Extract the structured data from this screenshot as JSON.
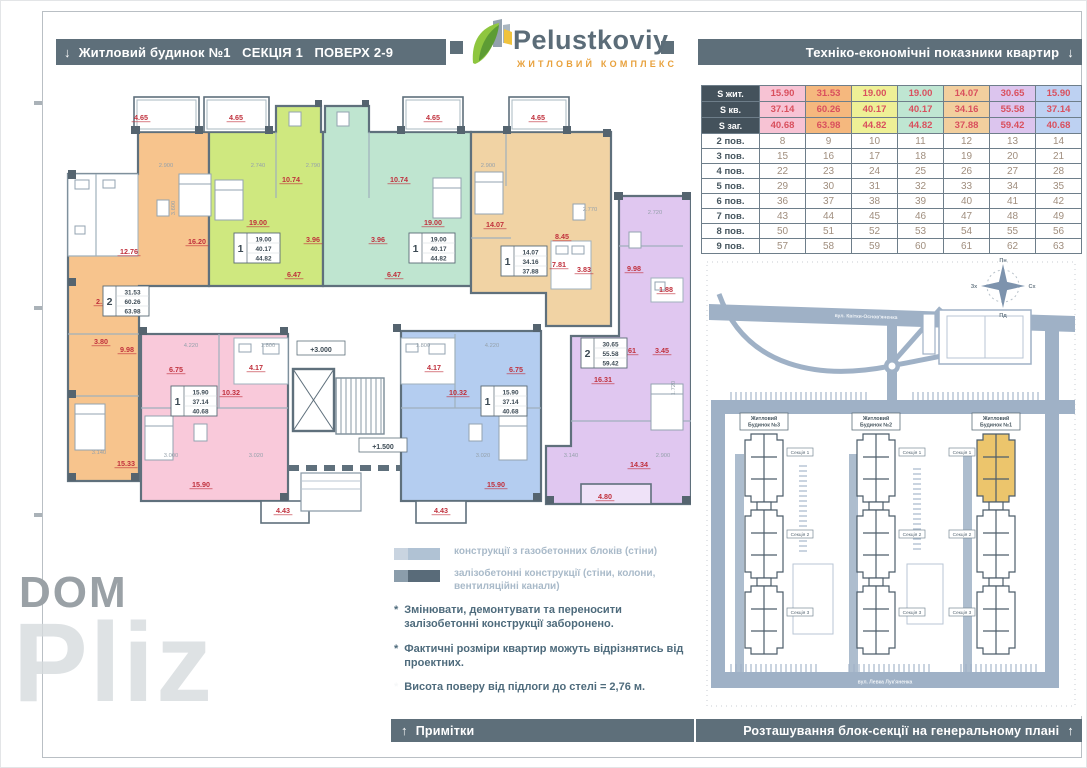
{
  "header": {
    "arrow_down": "↓",
    "left_title": "Житловий будинок №1   СЕКЦІЯ 1   ПОВЕРХ 2-9",
    "right_title": "Техніко-економічні показники квартир",
    "logo_name": "Pelustkoviy",
    "logo_subtitle": "ЖИТЛОВИЙ КОМПЛЕКС"
  },
  "table": {
    "area_rows": [
      {
        "label": "S жит.",
        "values": [
          "15.90",
          "31.53",
          "19.00",
          "19.00",
          "14.07",
          "30.65",
          "15.90"
        ]
      },
      {
        "label": "S кв.",
        "values": [
          "37.14",
          "60.26",
          "40.17",
          "40.17",
          "34.16",
          "55.58",
          "37.14"
        ]
      },
      {
        "label": "S заг.",
        "values": [
          "40.68",
          "63.98",
          "44.82",
          "44.82",
          "37.88",
          "59.42",
          "40.68"
        ]
      }
    ],
    "column_colors": [
      "#f7c3d4",
      "#f5b87e",
      "#eef096",
      "#bfe6d2",
      "#f2cf9e",
      "#dcc5ee",
      "#bdd1f2"
    ],
    "floor_rows": [
      {
        "label": "2 пов.",
        "values": [
          "8",
          "9",
          "10",
          "11",
          "12",
          "13",
          "14"
        ]
      },
      {
        "label": "3 пов.",
        "values": [
          "15",
          "16",
          "17",
          "18",
          "19",
          "20",
          "21"
        ]
      },
      {
        "label": "4 пов.",
        "values": [
          "22",
          "23",
          "24",
          "25",
          "26",
          "27",
          "28"
        ]
      },
      {
        "label": "5 пов.",
        "values": [
          "29",
          "30",
          "31",
          "32",
          "33",
          "34",
          "35"
        ]
      },
      {
        "label": "6 пов.",
        "values": [
          "36",
          "37",
          "38",
          "39",
          "40",
          "41",
          "42"
        ]
      },
      {
        "label": "7 пов.",
        "values": [
          "43",
          "44",
          "45",
          "46",
          "47",
          "48",
          "49"
        ]
      },
      {
        "label": "8 пов.",
        "values": [
          "50",
          "51",
          "52",
          "53",
          "54",
          "55",
          "56"
        ]
      },
      {
        "label": "9 пов.",
        "values": [
          "57",
          "58",
          "59",
          "60",
          "61",
          "62",
          "63"
        ]
      }
    ]
  },
  "floorplan": {
    "apartment_colors": {
      "orange": "#f7c48d",
      "lime": "#cfe87f",
      "teal": "#bfe5d0",
      "tan": "#f1d3a4",
      "purple": "#e0c7f0",
      "pink": "#f9c9da",
      "blue": "#b4cdf0"
    },
    "rooms": [
      {
        "t": "4.65",
        "x": 90,
        "y": 34
      },
      {
        "t": "4.65",
        "x": 185,
        "y": 34
      },
      {
        "t": "4.65",
        "x": 382,
        "y": 34
      },
      {
        "t": "4.65",
        "x": 487,
        "y": 34
      },
      {
        "t": "12.76",
        "x": 78,
        "y": 168
      },
      {
        "t": "16.20",
        "x": 146,
        "y": 158
      },
      {
        "t": "2.19",
        "x": 52,
        "y": 218
      },
      {
        "t": "3.80",
        "x": 50,
        "y": 258
      },
      {
        "t": "9.98",
        "x": 76,
        "y": 266
      },
      {
        "t": "15.33",
        "x": 75,
        "y": 380
      },
      {
        "t": "10.74",
        "x": 240,
        "y": 96
      },
      {
        "t": "19.00",
        "x": 207,
        "y": 139
      },
      {
        "t": "3.96",
        "x": 262,
        "y": 156
      },
      {
        "t": "6.47",
        "x": 243,
        "y": 191
      },
      {
        "t": "10.74",
        "x": 348,
        "y": 96
      },
      {
        "t": "19.00",
        "x": 382,
        "y": 139
      },
      {
        "t": "3.96",
        "x": 327,
        "y": 156
      },
      {
        "t": "6.47",
        "x": 343,
        "y": 191
      },
      {
        "t": "14.07",
        "x": 444,
        "y": 141
      },
      {
        "t": "8.45",
        "x": 511,
        "y": 153
      },
      {
        "t": "7.81",
        "x": 508,
        "y": 181
      },
      {
        "t": "3.83",
        "x": 533,
        "y": 186
      },
      {
        "t": "9.98",
        "x": 583,
        "y": 185
      },
      {
        "t": "1.88",
        "x": 615,
        "y": 206
      },
      {
        "t": "9.61",
        "x": 578,
        "y": 267
      },
      {
        "t": "3.45",
        "x": 611,
        "y": 267
      },
      {
        "t": "16.31",
        "x": 552,
        "y": 296
      },
      {
        "t": "14.34",
        "x": 588,
        "y": 381
      },
      {
        "t": "4.80",
        "x": 554,
        "y": 413
      },
      {
        "t": "6.75",
        "x": 125,
        "y": 286
      },
      {
        "t": "4.17",
        "x": 205,
        "y": 284
      },
      {
        "t": "10.32",
        "x": 180,
        "y": 309
      },
      {
        "t": "15.90",
        "x": 150,
        "y": 401
      },
      {
        "t": "4.43",
        "x": 232,
        "y": 427
      },
      {
        "t": "4.17",
        "x": 383,
        "y": 284
      },
      {
        "t": "6.75",
        "x": 465,
        "y": 286
      },
      {
        "t": "10.32",
        "x": 407,
        "y": 309
      },
      {
        "t": "15.90",
        "x": 445,
        "y": 401
      },
      {
        "t": "4.43",
        "x": 390,
        "y": 427
      }
    ],
    "info_boxes": [
      {
        "type": "2",
        "a": "31.53",
        "b": "60.26",
        "c": "63.98",
        "x": 52,
        "y": 200
      },
      {
        "type": "1",
        "a": "19.00",
        "b": "40.17",
        "c": "44.82",
        "x": 183,
        "y": 147
      },
      {
        "type": "1",
        "a": "19.00",
        "b": "40.17",
        "c": "44.82",
        "x": 358,
        "y": 147
      },
      {
        "type": "1",
        "a": "14.07",
        "b": "34.16",
        "c": "37.88",
        "x": 450,
        "y": 160
      },
      {
        "type": "2",
        "a": "30.65",
        "b": "55.58",
        "c": "59.42",
        "x": 530,
        "y": 252
      },
      {
        "type": "1",
        "a": "15.90",
        "b": "37.14",
        "c": "40.68",
        "x": 120,
        "y": 300
      },
      {
        "type": "1",
        "a": "15.90",
        "b": "37.14",
        "c": "40.68",
        "x": 430,
        "y": 300
      }
    ],
    "dims": [
      {
        "t": "2.900",
        "x": 115,
        "y": 81
      },
      {
        "t": "2.740",
        "x": 207,
        "y": 81
      },
      {
        "t": "2.790",
        "x": 262,
        "y": 81
      },
      {
        "t": "2.900",
        "x": 437,
        "y": 81
      },
      {
        "t": "2.770",
        "x": 539,
        "y": 125
      },
      {
        "t": "2.720",
        "x": 604,
        "y": 128
      },
      {
        "t": "3.600",
        "x": 124,
        "y": 122,
        "r": 1
      },
      {
        "t": "1.720",
        "x": 624,
        "y": 302,
        "r": 1
      },
      {
        "t": "4.220",
        "x": 140,
        "y": 261
      },
      {
        "t": "1.800",
        "x": 217,
        "y": 261
      },
      {
        "t": "1.800",
        "x": 372,
        "y": 261
      },
      {
        "t": "4.220",
        "x": 441,
        "y": 261
      },
      {
        "t": "3.000",
        "x": 120,
        "y": 371
      },
      {
        "t": "3.020",
        "x": 205,
        "y": 371
      },
      {
        "t": "3.020",
        "x": 432,
        "y": 371
      },
      {
        "t": "3.140",
        "x": 48,
        "y": 368
      },
      {
        "t": "3.140",
        "x": 520,
        "y": 371
      },
      {
        "t": "2.900",
        "x": 612,
        "y": 371
      }
    ],
    "levels": [
      {
        "t": "+3.000",
        "x": 270,
        "y": 264
      },
      {
        "t": "+1.500",
        "x": 332,
        "y": 361
      }
    ]
  },
  "legend": {
    "bullet": "*",
    "swatch1_label": "конструкції з газобетонних блоків (стіни)",
    "swatch1_colors": [
      "#c9d4e0",
      "#b0c2d4"
    ],
    "swatch2_label": "залізобетонні конструкції (стіни, колони, вентиляційні канали)",
    "swatch2_colors": [
      "#8b9dab",
      "#596b79"
    ],
    "notes": [
      "Змінювати, демонтувати та переносити залізобетонні конструкції заборонено.",
      "Фактичні розміри квартир можуть відрізнятись від проектних.",
      "Висота поверу від підлоги до стелі = 2,76 м."
    ]
  },
  "footer": {
    "arrow_up": "↑",
    "left_title": "Примітки",
    "right_title": "Розташування блок-секції на генеральному плані"
  },
  "siteplan": {
    "buildings": [
      {
        "line1": "Житловий",
        "line2": "Будинок №3"
      },
      {
        "line1": "Житловий",
        "line2": "Будинок №2"
      },
      {
        "line1": "Житловий",
        "line2": "Будинок №1"
      }
    ],
    "sections": [
      "Секція 1",
      "Секція 2",
      "Секція 3"
    ],
    "streets": {
      "top": "вул. Квітки-Основ'яненка",
      "bottom": "вул. Левка Лук'яненка"
    },
    "compass": {
      "n": "Пн",
      "e": "Сх",
      "s": "Пд",
      "w": "Зх"
    },
    "highlight_color": "#ecc56c"
  },
  "watermark": {
    "part1": "DOM",
    "part2": "Pliz",
    "part3": "info"
  }
}
